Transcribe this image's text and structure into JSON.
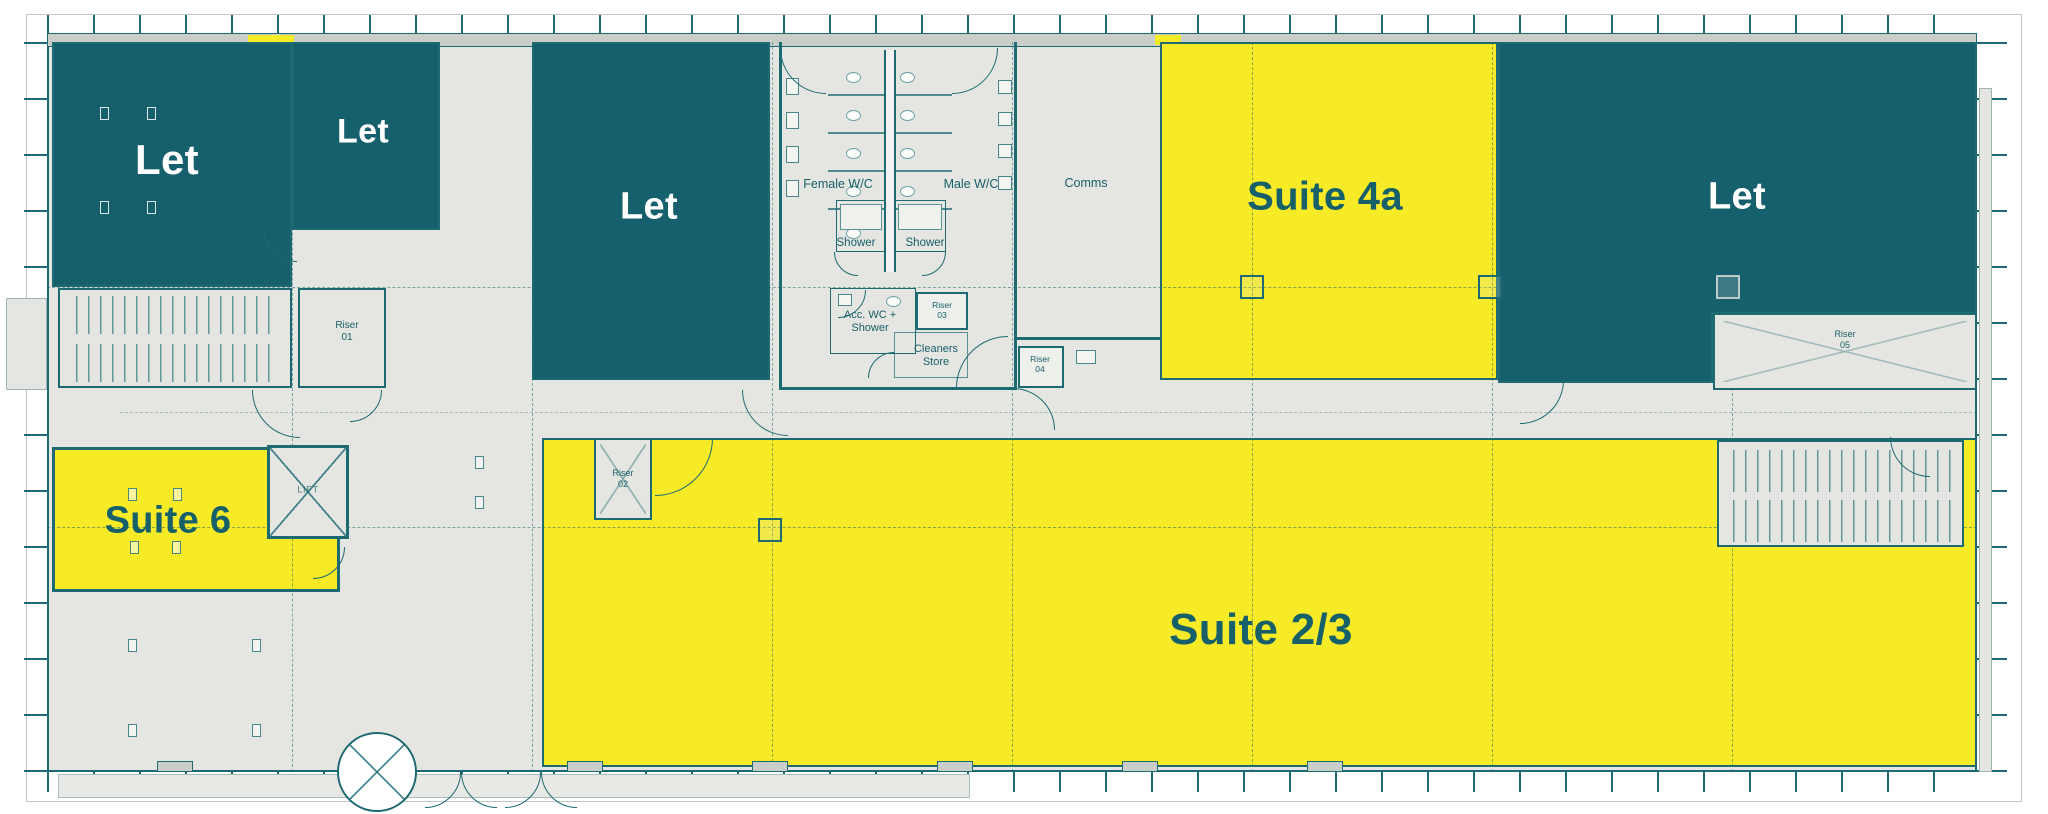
{
  "colors": {
    "teal": "#15606C",
    "yellow": "#F6EB26",
    "floor": "#E5E6E1",
    "wallband": "#C9CEC8",
    "line": "#1D6A72",
    "linelight": "#6FA2A8",
    "label": "#17606A"
  },
  "suites": [
    {
      "id": "let-a",
      "label": "Let",
      "status": "let"
    },
    {
      "id": "let-a2",
      "label": "Let",
      "status": "let"
    },
    {
      "id": "let-b",
      "label": "Let",
      "status": "let"
    },
    {
      "id": "suite-4a",
      "label": "Suite 4a",
      "status": "available"
    },
    {
      "id": "let-d",
      "label": "Let",
      "status": "let"
    },
    {
      "id": "suite-6",
      "label": "Suite 6",
      "status": "available"
    },
    {
      "id": "suite-2-3",
      "label": "Suite 2/3",
      "status": "available"
    }
  ],
  "rooms": {
    "female_wc": "Female W/C",
    "male_wc": "Male W/C",
    "comms": "Comms",
    "shower_left": "Shower",
    "shower_right": "Shower",
    "acc_wc_line1": "Acc. WC +",
    "acc_wc_line2": "Shower",
    "cleaners_line1": "Cleaners",
    "cleaners_line2": "Store",
    "lift": "LIFT"
  },
  "risers": [
    {
      "label": "Riser",
      "number": "01"
    },
    {
      "label": "Riser",
      "number": "02"
    },
    {
      "label": "Riser",
      "number": "03"
    },
    {
      "label": "Riser",
      "number": "04"
    },
    {
      "label": "Riser",
      "number": "05"
    }
  ]
}
